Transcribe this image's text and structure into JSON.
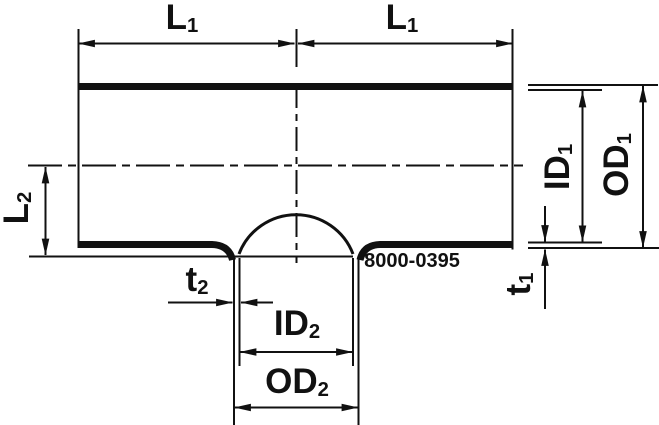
{
  "part_number": "8000-0395",
  "labels": {
    "l1_left": {
      "main": "L",
      "sub": "1"
    },
    "l1_right": {
      "main": "L",
      "sub": "1"
    },
    "l2": {
      "main": "L",
      "sub": "2"
    },
    "id1": {
      "main": "ID",
      "sub": "1"
    },
    "od1": {
      "main": "OD",
      "sub": "1"
    },
    "t1": {
      "main": "t",
      "sub": "1"
    },
    "t2": {
      "main": "t",
      "sub": "2"
    },
    "id2": {
      "main": "ID",
      "sub": "2"
    },
    "od2": {
      "main": "OD",
      "sub": "2"
    }
  },
  "colors": {
    "ink": "#111111",
    "background": "#ffffff"
  }
}
